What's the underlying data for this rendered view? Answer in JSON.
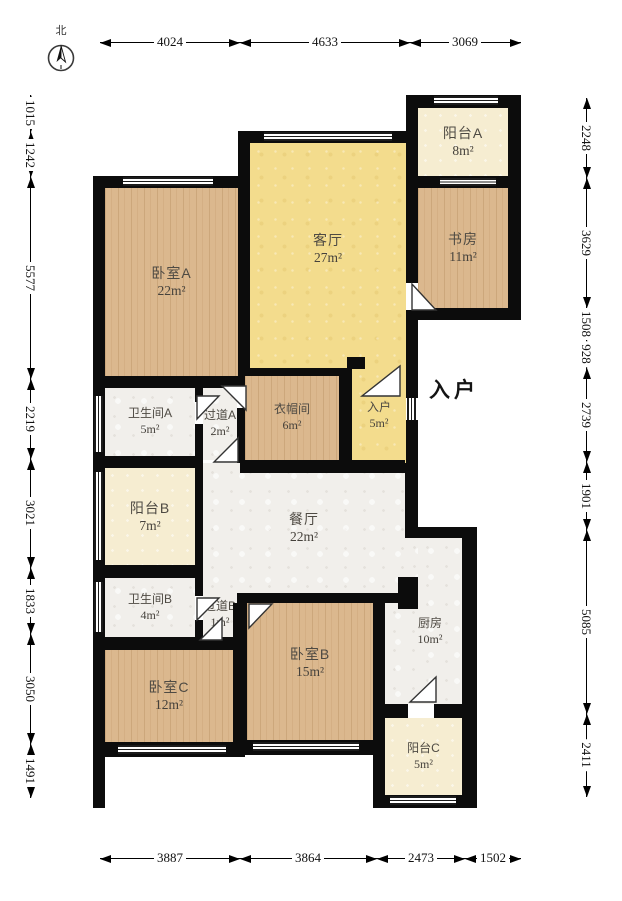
{
  "compass": {
    "label": "北"
  },
  "entry_marker": "入户",
  "rooms": {
    "bedroomA": {
      "label": "卧室A",
      "area": "22m²"
    },
    "livingRoom": {
      "label": "客厅",
      "area": "27m²"
    },
    "balconyA": {
      "label": "阳台A",
      "area": "8m²"
    },
    "study": {
      "label": "书房",
      "area": "11m²"
    },
    "bathroomA": {
      "label": "卫生间A",
      "area": "5m²"
    },
    "hallwayA": {
      "label": "过道A",
      "area": "2m²"
    },
    "cloakroom": {
      "label": "衣帽间",
      "area": "6m²"
    },
    "entry": {
      "label": "入户",
      "area": "5m²"
    },
    "balconyB": {
      "label": "阳台B",
      "area": "7m²"
    },
    "diningRoom": {
      "label": "餐厅",
      "area": "22m²"
    },
    "bathroomB": {
      "label": "卫生间B",
      "area": "4m²"
    },
    "hallwayB": {
      "label": "过道B",
      "area": "1m²"
    },
    "bedroomC": {
      "label": "卧室C",
      "area": "12m²"
    },
    "bedroomB": {
      "label": "卧室B",
      "area": "15m²"
    },
    "kitchen": {
      "label": "厨房",
      "area": "10m²"
    },
    "balconyC": {
      "label": "阳台C",
      "area": "5m²"
    }
  },
  "dimensions": {
    "top": [
      "4024",
      "4633",
      "3069"
    ],
    "bottom": [
      "3887",
      "3864",
      "2473",
      "1502"
    ],
    "left": [
      "1015",
      "1242",
      "5577",
      "2219",
      "3021",
      "1833",
      "3050",
      "1491"
    ],
    "right": [
      "2248",
      "3629",
      "1508",
      "928",
      "2739",
      "1901",
      "5085",
      "2411"
    ]
  },
  "colors": {
    "wall": "#0c0c0c",
    "wood": "#dbb88e",
    "living_yellow": "#f3dc8d",
    "balcony_cream": "#f6edd1",
    "service_grey": "#f1efeb"
  }
}
